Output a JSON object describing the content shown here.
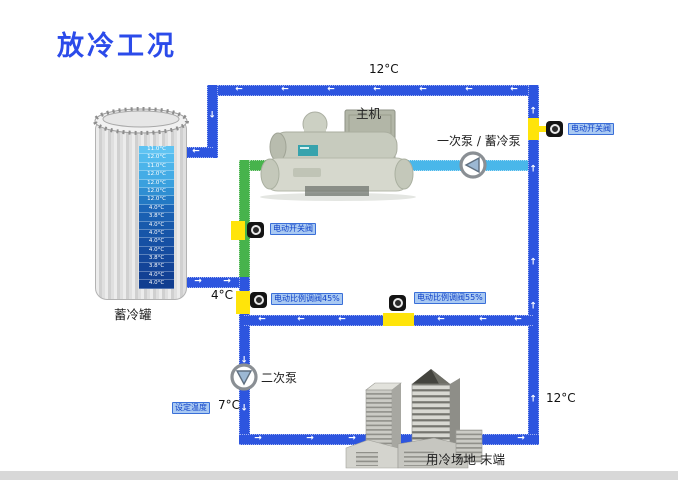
{
  "title": "放冷工况",
  "colors": {
    "accent_blue": "#2b4bea",
    "pipe_blue": "#2d55df",
    "pipe_cyan": "#49b7ea",
    "pipe_green": "#47b34c",
    "valve_yellow": "#ffe40a",
    "badge_bg": "#a9c9f2",
    "badge_text": "#1243c8"
  },
  "tank": {
    "label": "蓄冷罐",
    "temps": [
      "11.0°C",
      "12.0°C",
      "11.0°C",
      "12.0°C",
      "12.0°C",
      "12.0°C",
      "12.0°C",
      "4.0°C",
      "3.8°C",
      "4.0°C",
      "4.0°C",
      "4.0°C",
      "4.0°C",
      "3.8°C",
      "3.8°C",
      "4.0°C",
      "4.0°C"
    ],
    "temp_colors": [
      "#5fc3f2",
      "#53bbee",
      "#4cb4ea",
      "#44ace6",
      "#3aa0de",
      "#2f8ed2",
      "#2379c4",
      "#1c66b8",
      "#1a60b2",
      "#185aac",
      "#1755a8",
      "#1650a4",
      "#154ca0",
      "#14489c",
      "#134498",
      "#124194",
      "#113e90"
    ]
  },
  "chiller": {
    "label": "主机"
  },
  "pumps": {
    "primary": "一次泵 / 蓄冷泵",
    "secondary": "二次泵"
  },
  "valves": {
    "switch_main": "电动开关阀",
    "switch_right": "电动开关阀",
    "prop_left": "电动比例调阀45%",
    "prop_right": "电动比例调阀55%"
  },
  "temperatures": {
    "top_return": "12°C",
    "tank_outlet": "4°C",
    "supply": "7°C",
    "right_return": "12°C"
  },
  "set_temp_badge": "设定温度",
  "end_user": {
    "label": "用冷场地 末端"
  }
}
